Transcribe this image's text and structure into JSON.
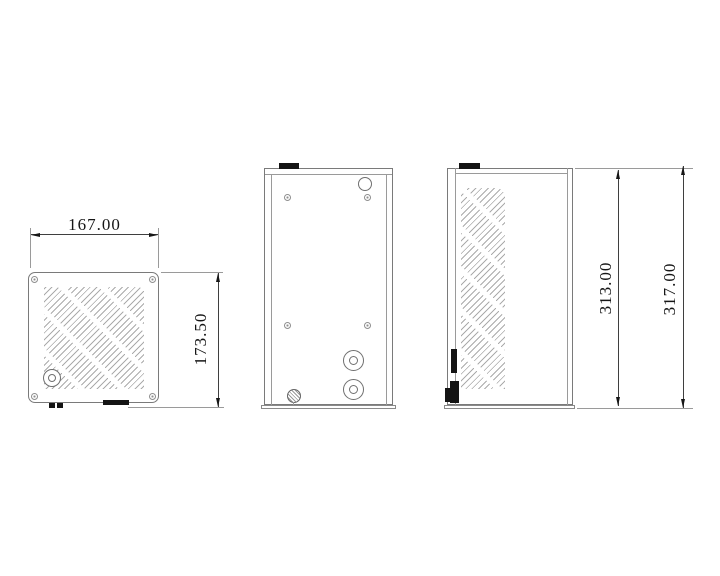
{
  "dimensions": {
    "front_width": "167.00",
    "front_height": "173.50",
    "side_body_height": "313.00",
    "side_overall_height": "317.00"
  },
  "colors": {
    "background": "#ffffff",
    "outline": "#7a7a7a",
    "dimension_line": "#3f3f3f",
    "text": "#161616",
    "black_fill": "#141414",
    "vent_stroke": "#ababab"
  }
}
